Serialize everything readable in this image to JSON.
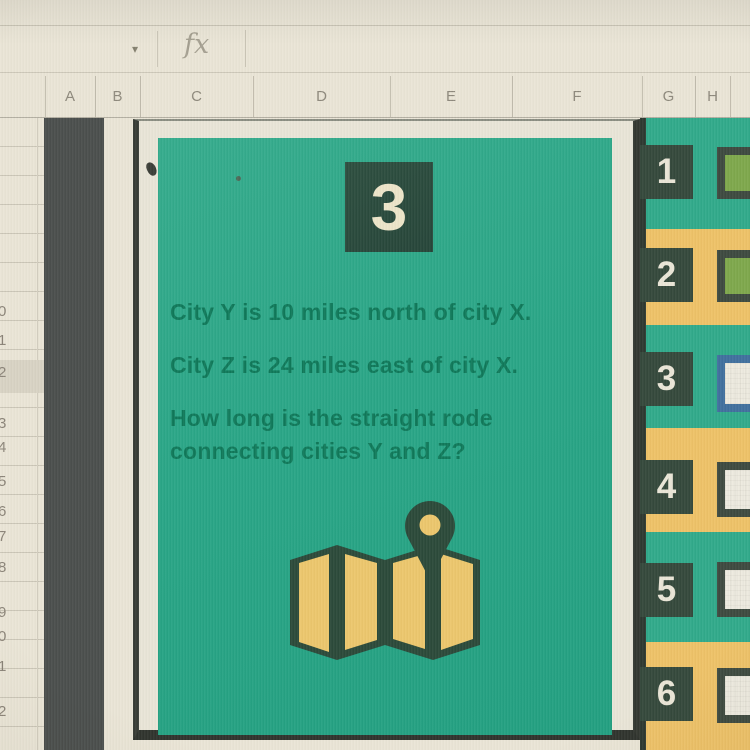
{
  "sheet": {
    "formula_bar": {
      "dropdown_glyph": "▾",
      "fx_label": "fx"
    },
    "column_headers": [
      "A",
      "B",
      "C",
      "D",
      "E",
      "F",
      "G",
      "H"
    ],
    "visible_row_digits": [
      "0",
      "1",
      "2",
      "3",
      "4",
      "5",
      "6",
      "7",
      "8",
      "9",
      "0",
      "1",
      "2"
    ]
  },
  "problem_card": {
    "number": "3",
    "lines": [
      "City Y is 10 miles north of city X.",
      "City Z is 24 miles east of city X.",
      "How long is the straight rode",
      "connecting cities Y and Z?"
    ],
    "icon": "folded-map-with-location-pin"
  },
  "answer_panel": {
    "rows": [
      {
        "number": "1",
        "band": "teal",
        "box_fill": "green",
        "box_border": "dark"
      },
      {
        "number": "2",
        "band": "yellow",
        "box_fill": "green",
        "box_border": "dark"
      },
      {
        "number": "3",
        "band": "teal",
        "box_fill": "white",
        "box_border": "blue"
      },
      {
        "number": "4",
        "band": "yellow",
        "box_fill": "white",
        "box_border": "dark"
      },
      {
        "number": "5",
        "band": "teal",
        "box_fill": "white",
        "box_border": "dark"
      },
      {
        "number": "6",
        "band": "yellow",
        "box_fill": "white",
        "box_border": "dark"
      }
    ]
  },
  "colors": {
    "screen_background": "#eae5d6",
    "card_teal": "#2aa687",
    "panel_teal": "#31aa8b",
    "panel_yellow": "#eec268",
    "dark_square_green": "#35493c",
    "card_frame_dark": "#383c35",
    "column_a_charcoal": "#4b4f4d",
    "problem_text_green": "#10795a",
    "numeral_cream": "#ede5c9",
    "map_icon_yellow": "#ecc76d",
    "map_icon_dark": "#2c4a3a",
    "answer_box_green": "#7ea84c",
    "answer_box_white": "#edeadf",
    "selected_box_border_blue": "#41709e"
  }
}
